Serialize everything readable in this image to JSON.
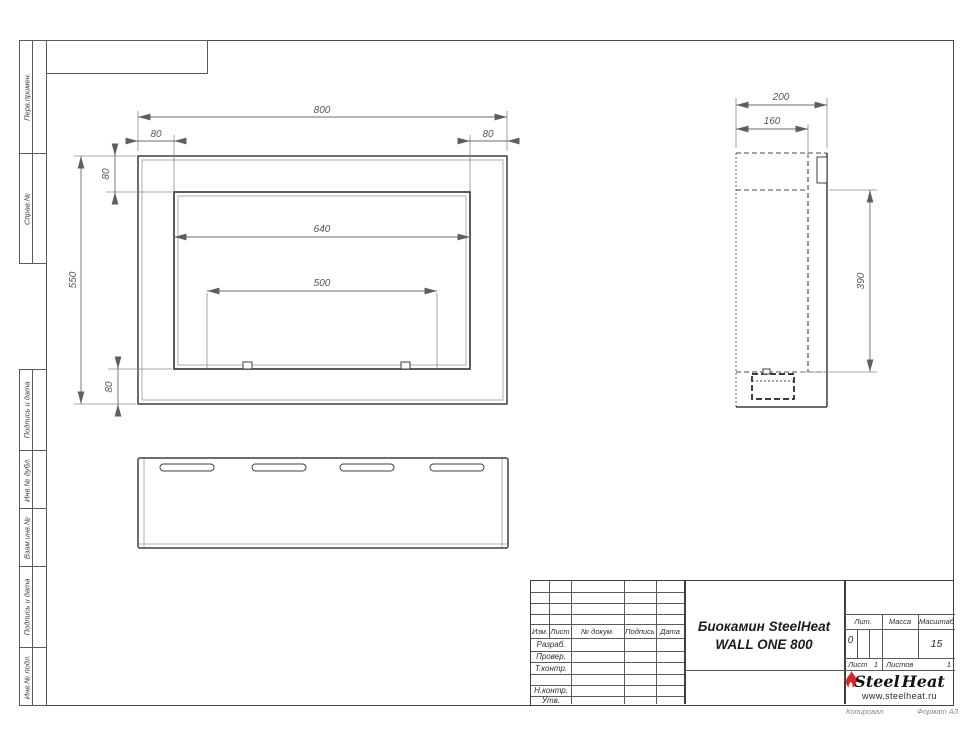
{
  "sheet": {
    "copied_label": "Копировал",
    "format_label": "Формат А3",
    "left_strip": {
      "cells": [
        "Перв.примен.",
        "Справ.№",
        "Подпись и дата",
        "Инв.№ дубл.",
        "Взам.инв.№",
        "Подпись и дата",
        "Инв.№ подл."
      ]
    }
  },
  "drawing": {
    "front_view": {
      "dim_width_total": "800",
      "dim_flange_left": "80",
      "dim_flange_right": "80",
      "dim_flange_top": "80",
      "dim_height_total": "550",
      "dim_opening_width": "640",
      "dim_inner_span": "500",
      "dim_flange_bottom": "80"
    },
    "side_view": {
      "dim_depth_total": "200",
      "dim_depth_inner": "160",
      "dim_height_inner": "390"
    }
  },
  "title_block": {
    "columns": {
      "izm": "Изм.",
      "list": "Лист",
      "doc": "№ докум.",
      "sign": "Подпись",
      "date": "Дата"
    },
    "rows": {
      "razrab": "Разраб.",
      "prover": "Провер.",
      "tkontr": "Т.контр.",
      "nkontr": "Н.контр.",
      "utv": "Утв."
    },
    "title_line1": "Биокамин SteelHeat",
    "title_line2": "WALL ONE 800",
    "lit_label": "Лит.",
    "lit_value": "0",
    "mass_label": "Масса",
    "scale_label": "Масштаб",
    "scale_value": "15",
    "sheet_label": "Лист",
    "sheet_value": "1",
    "sheets_label": "Листов",
    "sheets_value": "1",
    "logo": {
      "part1": "Steel",
      "part2": "Heat",
      "url": "www.steelheat.ru",
      "flame_color": "#e31e24"
    }
  }
}
